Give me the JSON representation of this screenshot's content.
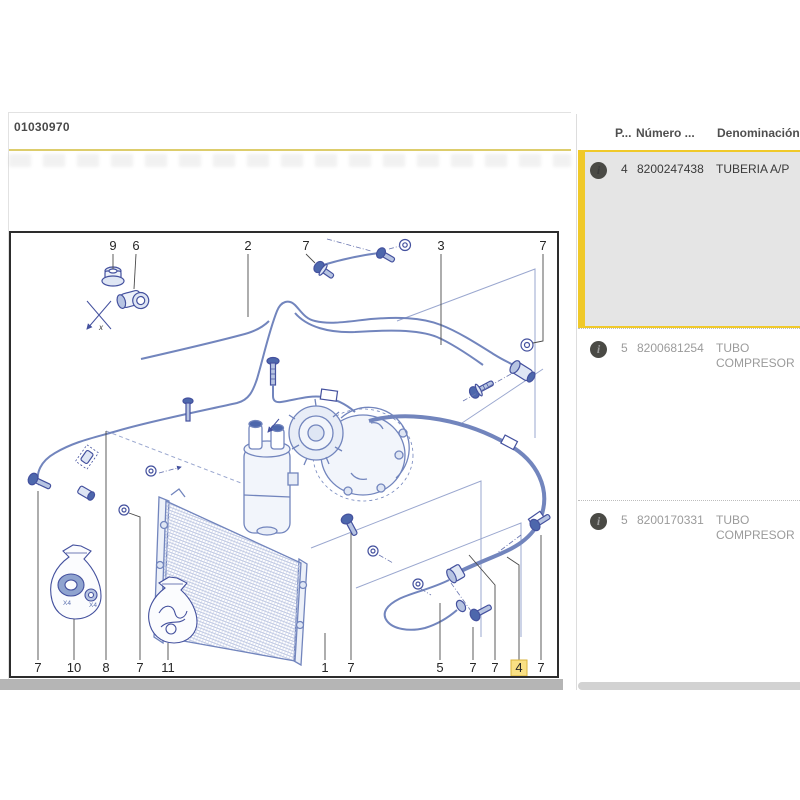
{
  "page": {
    "code": "01030970"
  },
  "right_panel": {
    "columns": {
      "pos": "P...",
      "number": "Número ...",
      "name": "Denominación"
    },
    "info_icon_glyph": "i",
    "rows": [
      {
        "pos": "4",
        "number": "8200247438",
        "name": "TUBERIA A/P",
        "selected": true
      },
      {
        "pos": "5",
        "number": "8200681254",
        "name": "TUBO COMPRESOR",
        "selected": false
      },
      {
        "pos": "5",
        "number": "8200170331",
        "name": "TUBO COMPRESOR",
        "selected": false
      }
    ]
  },
  "diagram": {
    "callouts": [
      {
        "label": "9",
        "x": 102,
        "y": 17,
        "leader": [
          [
            102,
            21
          ],
          [
            102,
            36
          ]
        ]
      },
      {
        "label": "6",
        "x": 125,
        "y": 17,
        "leader": [
          [
            125,
            21
          ],
          [
            123,
            56
          ]
        ]
      },
      {
        "label": "2",
        "x": 237,
        "y": 17,
        "leader": [
          [
            237,
            21
          ],
          [
            237,
            84
          ]
        ]
      },
      {
        "label": "7",
        "x": 295,
        "y": 17,
        "leader": [
          [
            295,
            21
          ],
          [
            304,
            30
          ]
        ]
      },
      {
        "label": "3",
        "x": 430,
        "y": 17,
        "leader": [
          [
            430,
            21
          ],
          [
            430,
            112
          ]
        ]
      },
      {
        "label": "7",
        "x": 532,
        "y": 17,
        "leader": [
          [
            532,
            21
          ],
          [
            532,
            108
          ],
          [
            522,
            110
          ]
        ]
      },
      {
        "label": "7",
        "x": 27,
        "y": 439,
        "leader": [
          [
            27,
            427
          ],
          [
            27,
            258
          ]
        ]
      },
      {
        "label": "10",
        "x": 63,
        "y": 439,
        "leader": [
          [
            63,
            427
          ],
          [
            63,
            386
          ]
        ]
      },
      {
        "label": "8",
        "x": 95,
        "y": 439,
        "leader": [
          [
            95,
            427
          ],
          [
            95,
            198
          ]
        ]
      },
      {
        "label": "7",
        "x": 129,
        "y": 439,
        "leader": [
          [
            129,
            427
          ],
          [
            129,
            284
          ],
          [
            118,
            280
          ]
        ]
      },
      {
        "label": "11",
        "x": 157,
        "y": 439,
        "leader": [
          [
            157,
            427
          ],
          [
            157,
            410
          ]
        ]
      },
      {
        "label": "1",
        "x": 314,
        "y": 439,
        "leader": [
          [
            314,
            427
          ],
          [
            314,
            400
          ]
        ]
      },
      {
        "label": "7",
        "x": 340,
        "y": 439,
        "leader": [
          [
            340,
            427
          ],
          [
            340,
            300
          ]
        ]
      },
      {
        "label": "5",
        "x": 429,
        "y": 439,
        "leader": [
          [
            429,
            427
          ],
          [
            429,
            370
          ]
        ]
      },
      {
        "label": "7",
        "x": 462,
        "y": 439,
        "leader": [
          [
            462,
            427
          ],
          [
            462,
            394
          ]
        ]
      },
      {
        "label": "7",
        "x": 484,
        "y": 439,
        "leader": [
          [
            484,
            427
          ],
          [
            484,
            352
          ],
          [
            458,
            322
          ]
        ]
      },
      {
        "label": "4",
        "x": 508,
        "y": 439,
        "leader": [
          [
            508,
            427
          ],
          [
            508,
            332
          ],
          [
            496,
            324
          ]
        ],
        "highlight": true
      },
      {
        "label": "7",
        "x": 530,
        "y": 439,
        "leader": [
          [
            530,
            427
          ],
          [
            530,
            302
          ]
        ]
      }
    ],
    "labels": [
      {
        "text": "x",
        "x": 88,
        "y": 97,
        "size": 8,
        "color": "#3a3a3a",
        "italic": true
      },
      {
        "text": "X4",
        "x": 52,
        "y": 372,
        "size": 6.5,
        "color": "#5a6fae",
        "italic": false
      },
      {
        "text": "X4",
        "x": 78,
        "y": 374,
        "size": 6.5,
        "color": "#5a6fae",
        "italic": false
      }
    ]
  },
  "colors": {
    "accent_yellow": "#f0c929",
    "rule_yellow": "#ddcd6c",
    "highlight_bg": "#f9e084",
    "highlight_border": "#d9b33c",
    "selected_row_bg": "#e5e5e5",
    "muted_text": "#9b9b9b",
    "dark_text": "#3a3a3a",
    "drawing_stroke": "#7285bd",
    "drawing_dark": "#4d67ac",
    "frame": "#2d2d2d"
  }
}
